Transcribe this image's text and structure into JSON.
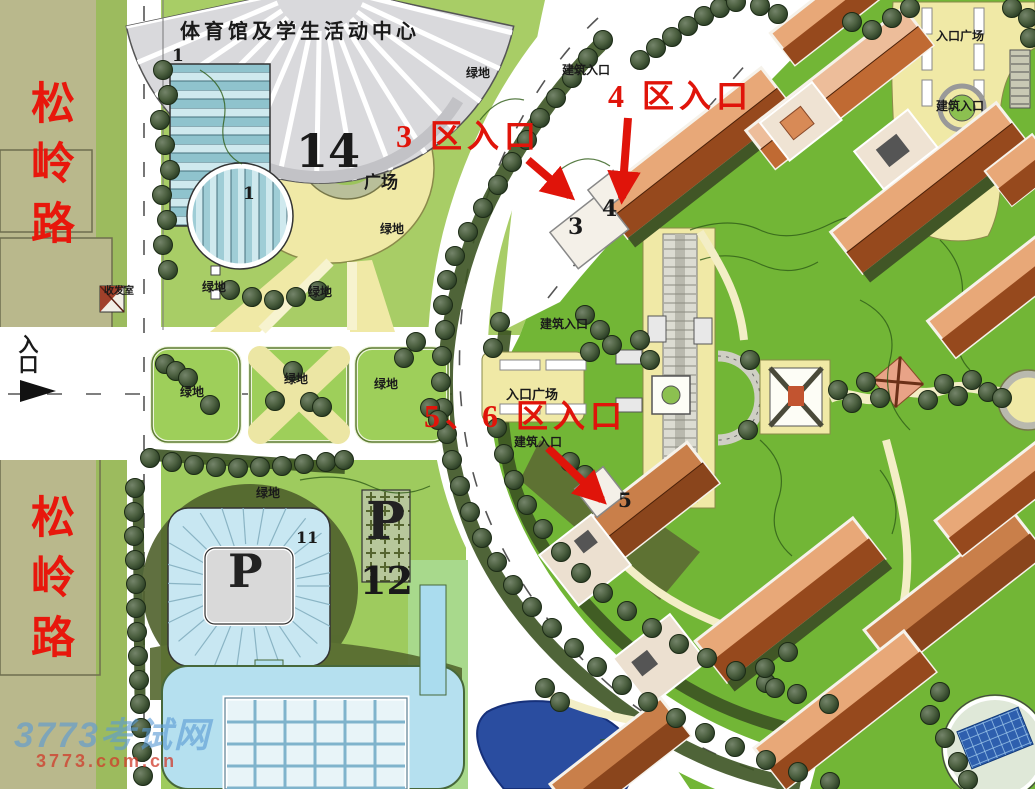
{
  "map": {
    "title": "体育馆及学生活动中心",
    "road_name": "松岭路",
    "entrance_label": "入口",
    "mail_room_label": "收发室",
    "labels": {
      "green_space": "绿地",
      "building_entrance": "建筑入口",
      "entrance_plaza": "入口广场",
      "plaza_suffix": "广场"
    },
    "zone_entrances": {
      "zone3": "3 区入口",
      "zone4": "4 区入口",
      "zone56": "5、6 区入口"
    },
    "numbers": {
      "gym": "14",
      "stripe_building": "1",
      "zone3_building": "3",
      "zone4_building": "4",
      "zone5_building": "5",
      "parking_building": "11",
      "parking_lot": "12",
      "parking_symbol": "P"
    },
    "watermark": {
      "site_name": "3773考试网",
      "site_url": "3773.com.cn"
    },
    "colors": {
      "annotation_red": "#e0140a",
      "road_label_red": "#e8170c",
      "lawn_light": "#a8cd66",
      "lawn_bright": "#72b636",
      "plaza_yellow": "#f0e9a6",
      "roof_dark": "#96491d",
      "roof_light": "#e8a878",
      "pond_blue": "#2a4da0",
      "pool_blue": "#b5e0ef",
      "olive_band": "#b9b88c"
    }
  }
}
